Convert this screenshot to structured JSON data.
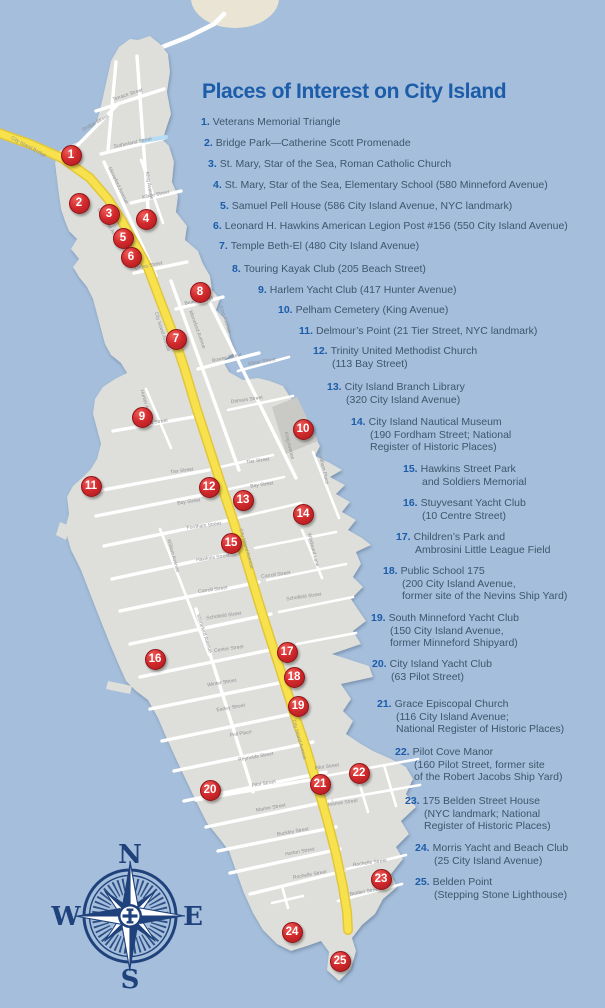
{
  "title": "Places of Interest on City Island",
  "colors": {
    "accent_blue": "#1c5ca9",
    "list_text": "#3f556c",
    "marker_red": "#c9252b",
    "water": "#a4bedb",
    "island": "#dededa",
    "avenue_yellow": "#f7e24e",
    "compass_navy": "#20427c",
    "cemetery_gray": "#c9cac5",
    "high_island_cream": "#eae4d5",
    "street_label_gray": "#8f9296"
  },
  "list": {
    "items": [
      {
        "num": "1.",
        "x": 201,
        "y": 116,
        "lines": [
          "Veterans Memorial Triangle"
        ]
      },
      {
        "num": "2.",
        "x": 204,
        "y": 137,
        "lines": [
          "Bridge Park—Catherine Scott Promenade"
        ]
      },
      {
        "num": "3.",
        "x": 208,
        "y": 158,
        "lines": [
          "St. Mary, Star of the Sea, Roman Catholic Church"
        ]
      },
      {
        "num": "4.",
        "x": 213,
        "y": 179,
        "lines": [
          "St. Mary, Star of the Sea, Elementary School (580 Minneford Avenue)"
        ]
      },
      {
        "num": "5.",
        "x": 220,
        "y": 200,
        "lines": [
          "Samuel Pell House (586 City Island Avenue, NYC landmark)"
        ]
      },
      {
        "num": "6.",
        "x": 213,
        "y": 220,
        "lines": [
          "Leonard H. Hawkins American Legion Post #156 (550 City Island Avenue)"
        ]
      },
      {
        "num": "7.",
        "x": 219,
        "y": 240,
        "lines": [
          "Temple Beth-El (480 City Island Avenue)"
        ]
      },
      {
        "num": "8.",
        "x": 232,
        "y": 263,
        "lines": [
          "Touring Kayak Club (205 Beach Street)"
        ]
      },
      {
        "num": "9.",
        "x": 258,
        "y": 284,
        "lines": [
          "Harlem Yacht Club (417 Hunter Avenue)"
        ]
      },
      {
        "num": "10.",
        "x": 278,
        "y": 304,
        "lines": [
          "Pelham Cemetery (King Avenue)"
        ]
      },
      {
        "num": "11.",
        "x": 299,
        "y": 325,
        "lines": [
          "Delmour’s Point (21 Tier Street, NYC landmark)"
        ]
      },
      {
        "num": "12.",
        "x": 313,
        "y": 345,
        "lines": [
          "Trinity United Methodist Church",
          "(113 Bay Street)"
        ]
      },
      {
        "num": "13.",
        "x": 327,
        "y": 381,
        "lines": [
          "City Island Branch Library",
          "(320 City Island Avenue)"
        ]
      },
      {
        "num": "14.",
        "x": 351,
        "y": 416,
        "lines": [
          "City Island Nautical Museum",
          "(190 Fordham Street; National",
          "Register of Historic Places)"
        ]
      },
      {
        "num": "15.",
        "x": 403,
        "y": 463,
        "lines": [
          "Hawkins Street Park",
          "and Soldiers Memorial"
        ]
      },
      {
        "num": "16.",
        "x": 403,
        "y": 497,
        "lines": [
          "Stuyvesant Yacht Club",
          "(10 Centre Street)"
        ]
      },
      {
        "num": "17.",
        "x": 396,
        "y": 531,
        "lines": [
          "Children’s Park and",
          "Ambrosini Little League Field"
        ]
      },
      {
        "num": "18.",
        "x": 383,
        "y": 565,
        "lines": [
          "Public School 175",
          "(200 City Island Avenue,",
          "former site of the Nevins Ship Yard)"
        ]
      },
      {
        "num": "19.",
        "x": 371,
        "y": 612,
        "lines": [
          "South Minneford Yacht Club",
          "(150 City Island Avenue,",
          "former Minneford Shipyard)"
        ]
      },
      {
        "num": "20.",
        "x": 372,
        "y": 658,
        "lines": [
          "City Island Yacht Club",
          "(63 Pilot Street)"
        ]
      },
      {
        "num": "21.",
        "x": 377,
        "y": 698,
        "lines": [
          "Grace Episcopal Church",
          "(116 City Island Avenue;",
          "National Register of Historic Places)"
        ]
      },
      {
        "num": "22.",
        "x": 395,
        "y": 746,
        "lines": [
          "Pilot Cove Manor",
          "(160 Pilot Street, former site",
          "of the Robert Jacobs Ship Yard)"
        ]
      },
      {
        "num": "23.",
        "x": 405,
        "y": 795,
        "lines": [
          "175 Belden Street House",
          "(NYC landmark; National",
          "Register of Historic Places)"
        ]
      },
      {
        "num": "24.",
        "x": 415,
        "y": 842,
        "lines": [
          "Morris Yacht and Beach Club",
          "(25 City Island Avenue)"
        ]
      },
      {
        "num": "25.",
        "x": 415,
        "y": 876,
        "lines": [
          "Belden Point",
          "(Stepping Stone Lighthouse)"
        ]
      }
    ]
  },
  "map": {
    "markers": [
      {
        "n": "1",
        "x": 71,
        "y": 155
      },
      {
        "n": "2",
        "x": 79,
        "y": 203
      },
      {
        "n": "3",
        "x": 109,
        "y": 214
      },
      {
        "n": "4",
        "x": 146,
        "y": 219
      },
      {
        "n": "5",
        "x": 123,
        "y": 238
      },
      {
        "n": "6",
        "x": 131,
        "y": 257
      },
      {
        "n": "7",
        "x": 176,
        "y": 339
      },
      {
        "n": "8",
        "x": 200,
        "y": 292
      },
      {
        "n": "9",
        "x": 142,
        "y": 417
      },
      {
        "n": "10",
        "x": 303,
        "y": 429
      },
      {
        "n": "11",
        "x": 91,
        "y": 486
      },
      {
        "n": "12",
        "x": 209,
        "y": 487
      },
      {
        "n": "13",
        "x": 243,
        "y": 500
      },
      {
        "n": "14",
        "x": 303,
        "y": 514
      },
      {
        "n": "15",
        "x": 231,
        "y": 543
      },
      {
        "n": "16",
        "x": 155,
        "y": 659
      },
      {
        "n": "17",
        "x": 287,
        "y": 652
      },
      {
        "n": "18",
        "x": 294,
        "y": 677
      },
      {
        "n": "19",
        "x": 298,
        "y": 706
      },
      {
        "n": "20",
        "x": 210,
        "y": 790
      },
      {
        "n": "21",
        "x": 320,
        "y": 784
      },
      {
        "n": "22",
        "x": 359,
        "y": 773
      },
      {
        "n": "23",
        "x": 381,
        "y": 879
      },
      {
        "n": "24",
        "x": 292,
        "y": 932
      },
      {
        "n": "25",
        "x": 340,
        "y": 961
      }
    ],
    "streets": [
      {
        "name": "Terrace Street",
        "x": 128,
        "y": 96,
        "a": -18
      },
      {
        "name": "Bridge Street",
        "x": 96,
        "y": 124,
        "a": -30
      },
      {
        "name": "Sutherland Street",
        "x": 133,
        "y": 144,
        "a": -12
      },
      {
        "name": "Minneford Avenue",
        "x": 117,
        "y": 186,
        "a": 64
      },
      {
        "name": "King Avenue",
        "x": 148,
        "y": 186,
        "a": 80
      },
      {
        "name": "Kilroe Street",
        "x": 156,
        "y": 196,
        "a": -12
      },
      {
        "name": "Cross Street",
        "x": 149,
        "y": 267,
        "a": -12
      },
      {
        "name": "Beach Street",
        "x": 199,
        "y": 302,
        "a": -12
      },
      {
        "name": "Minneford Avenue",
        "x": 196,
        "y": 330,
        "a": 70
      },
      {
        "name": "King Avenue",
        "x": 224,
        "y": 320,
        "a": 72
      },
      {
        "name": "Bowne Street",
        "x": 227,
        "y": 359,
        "a": -12
      },
      {
        "name": "Kilroe Street",
        "x": 262,
        "y": 363,
        "a": -10
      },
      {
        "name": "Ditmars Street",
        "x": 152,
        "y": 424,
        "a": -8
      },
      {
        "name": "Ditmars Street",
        "x": 247,
        "y": 401,
        "a": -8
      },
      {
        "name": "Hunter Avenue",
        "x": 145,
        "y": 406,
        "a": 74
      },
      {
        "name": "Tier Street",
        "x": 182,
        "y": 472,
        "a": -8
      },
      {
        "name": "Tier Street",
        "x": 258,
        "y": 462,
        "a": -8
      },
      {
        "name": "Bay Street",
        "x": 189,
        "y": 503,
        "a": -8
      },
      {
        "name": "Bay Street",
        "x": 262,
        "y": 486,
        "a": -8
      },
      {
        "name": "King Avenue",
        "x": 288,
        "y": 446,
        "a": 76
      },
      {
        "name": "Fordham Place",
        "x": 322,
        "y": 468,
        "a": 76
      },
      {
        "name": "Fordham Street",
        "x": 204,
        "y": 527,
        "a": -8
      },
      {
        "name": "Hawkins Street",
        "x": 213,
        "y": 559,
        "a": -8
      },
      {
        "name": "Carroll Street",
        "x": 213,
        "y": 591,
        "a": -8
      },
      {
        "name": "Carroll Street",
        "x": 276,
        "y": 576,
        "a": -8
      },
      {
        "name": "Schofield Street",
        "x": 224,
        "y": 617,
        "a": -8
      },
      {
        "name": "Schofield Street",
        "x": 304,
        "y": 598,
        "a": -8
      },
      {
        "name": "Centre Street",
        "x": 229,
        "y": 650,
        "a": -8
      },
      {
        "name": "Windward Lane",
        "x": 312,
        "y": 550,
        "a": 76
      },
      {
        "name": "William Avenue",
        "x": 172,
        "y": 556,
        "a": 74
      },
      {
        "name": "Minneford Avenue",
        "x": 203,
        "y": 634,
        "a": 72
      },
      {
        "name": "Winter Street",
        "x": 222,
        "y": 684,
        "a": -10
      },
      {
        "name": "Earley Street",
        "x": 231,
        "y": 709,
        "a": -10
      },
      {
        "name": "Pell Place",
        "x": 241,
        "y": 735,
        "a": -10
      },
      {
        "name": "Reynolds Street",
        "x": 256,
        "y": 758,
        "a": -10
      },
      {
        "name": "Pilot Street",
        "x": 264,
        "y": 785,
        "a": -10
      },
      {
        "name": "Pilot Street",
        "x": 327,
        "y": 768,
        "a": -8
      },
      {
        "name": "Marine Street",
        "x": 271,
        "y": 809,
        "a": -10
      },
      {
        "name": "Marine Street",
        "x": 343,
        "y": 804,
        "a": -8
      },
      {
        "name": "Buckley Street",
        "x": 293,
        "y": 833,
        "a": -10
      },
      {
        "name": "Horton Street",
        "x": 300,
        "y": 853,
        "a": -10
      },
      {
        "name": "Rochelle Street",
        "x": 310,
        "y": 876,
        "a": -10
      },
      {
        "name": "Rochelle Street",
        "x": 370,
        "y": 864,
        "a": -8
      },
      {
        "name": "Belden Street",
        "x": 365,
        "y": 893,
        "a": -10
      },
      {
        "name": "City Island Bridge",
        "x": 28,
        "y": 148,
        "a": 28
      },
      {
        "name": "City Island Avenue",
        "x": 108,
        "y": 227,
        "a": 58
      },
      {
        "name": "City Island Avenue",
        "x": 161,
        "y": 332,
        "a": 72
      },
      {
        "name": "City Island Avenue",
        "x": 245,
        "y": 549,
        "a": 74
      },
      {
        "name": "City Island Avenue",
        "x": 298,
        "y": 740,
        "a": 74
      }
    ],
    "compass": {
      "n": "N",
      "e": "E",
      "s": "S",
      "w": "W"
    }
  }
}
